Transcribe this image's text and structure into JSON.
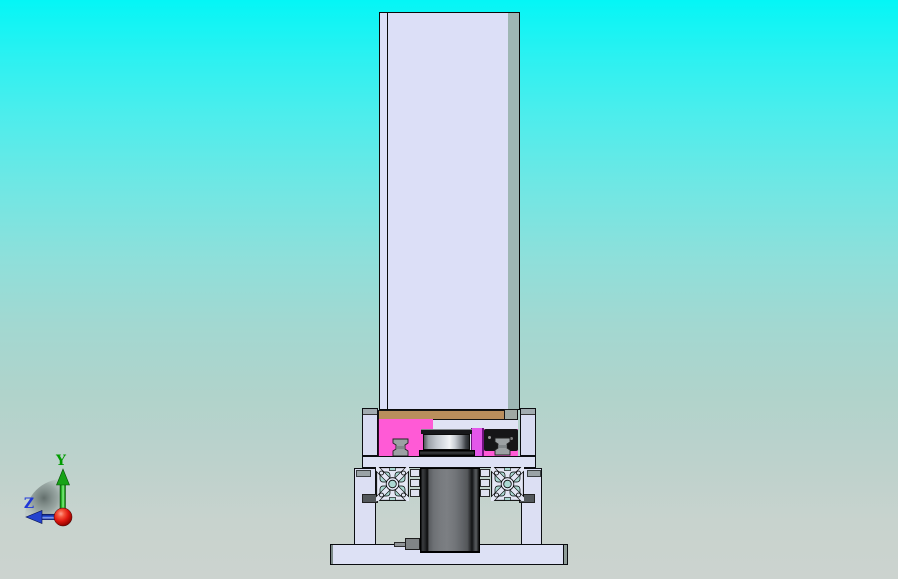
{
  "viewport": {
    "axis_triad": {
      "y_label": "Y",
      "z_label": "Z",
      "y_color": "#009c00",
      "z_color": "#2038d8",
      "origin_color": "#e01810"
    },
    "colors": {
      "background_top": "#00f6f6",
      "background_bottom": "#ccd3cf",
      "column_face": "#dcdff7",
      "column_side": "#9eb6b4",
      "crossbar_tan": "#b98e5c",
      "carriage_pink": "#ff5ad6",
      "spacer_magenta": "#e356ea",
      "pulley_silver": "#eef0f3",
      "motor_body_gray": "#74777b",
      "mount_black": "#161617",
      "frame_lavender": "#dde1f5",
      "clamp_gray": "#9ca1a3"
    }
  }
}
